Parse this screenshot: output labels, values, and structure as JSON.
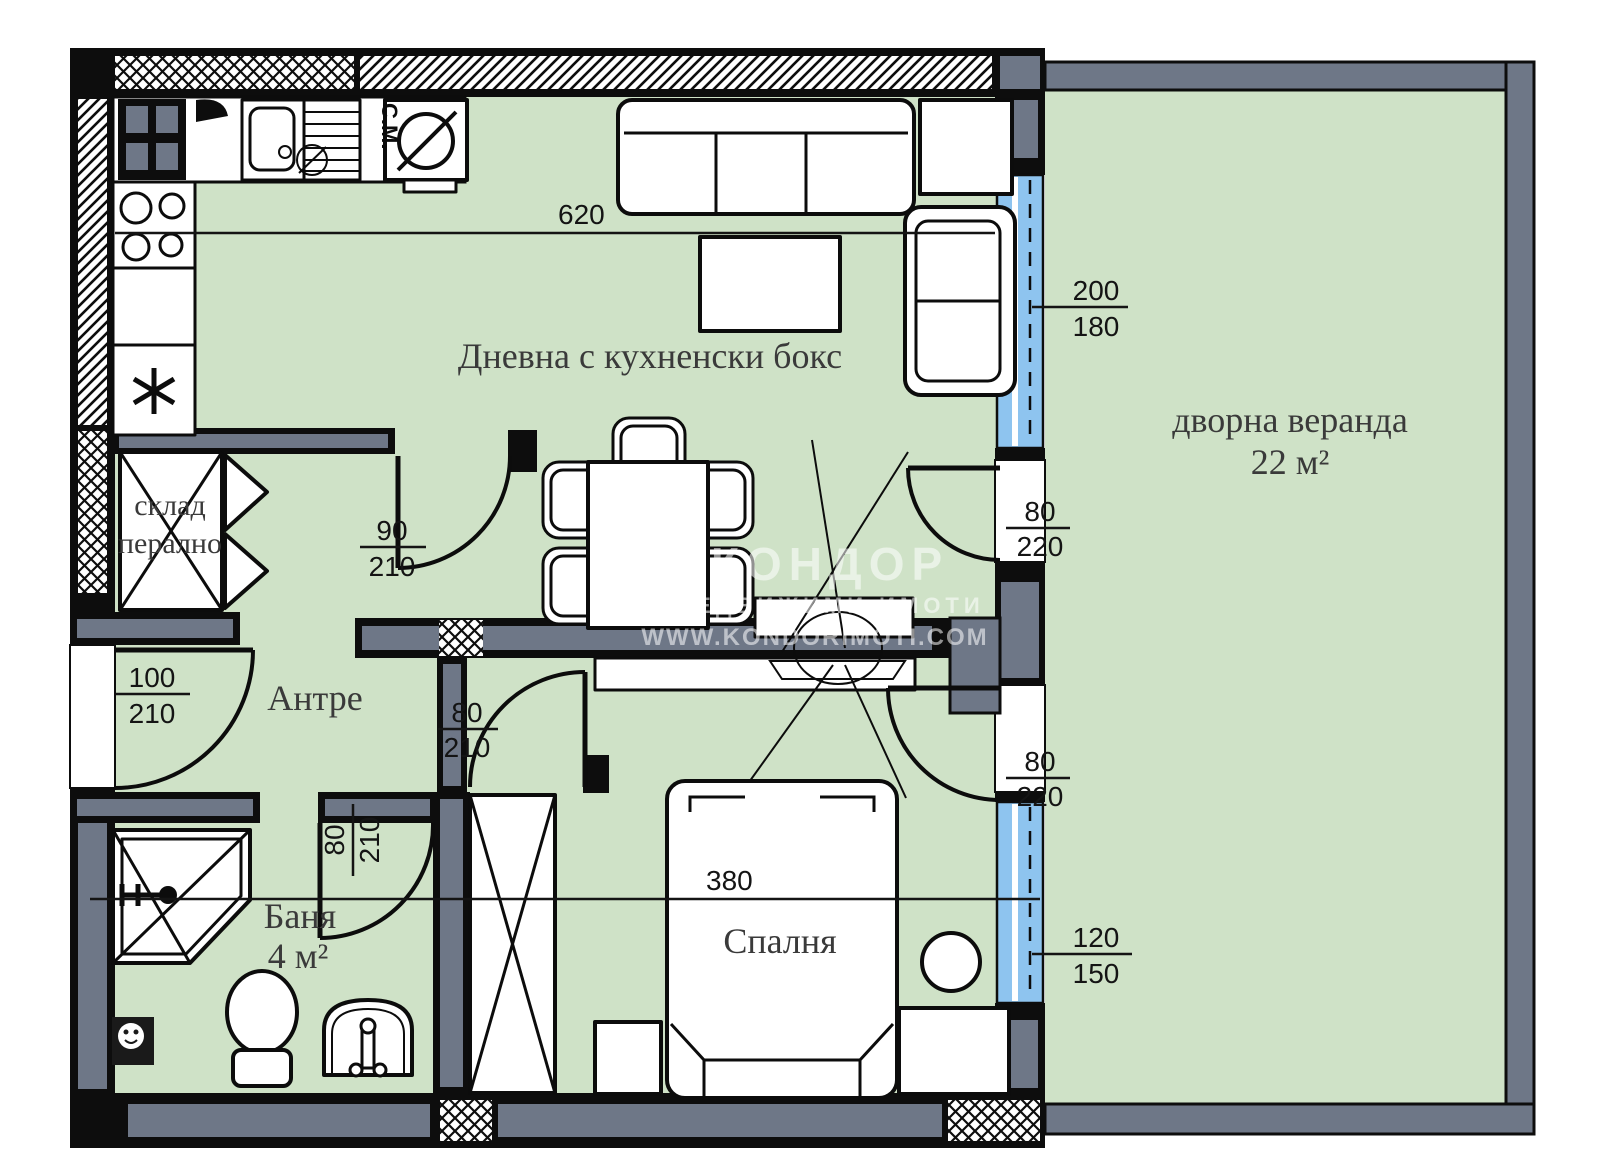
{
  "document": {
    "type": "apartment-floor-plan"
  },
  "rooms": {
    "living": {
      "label": "Дневна с кухненски бокс"
    },
    "veranda": {
      "label": "дворна веранда",
      "area": "22 м²"
    },
    "antre": {
      "label": "Антре"
    },
    "bath": {
      "label": "Баня",
      "area": "4 м²"
    },
    "bedroom": {
      "label": "Спалня"
    },
    "storage": {
      "label_line1": "склад",
      "label_line2": "перално"
    }
  },
  "appliances": {
    "washing_machine_abbr": "С.М."
  },
  "dimensions": {
    "living_width": "620",
    "bedroom_width": "380",
    "window_living": {
      "w": "200",
      "h": "180"
    },
    "door_terrace_top": {
      "w": "80",
      "h": "220"
    },
    "door_living": {
      "w": "90",
      "h": "210"
    },
    "door_entrance": {
      "w": "100",
      "h": "210"
    },
    "door_bedroom": {
      "w": "80",
      "h": "210"
    },
    "door_bath": {
      "w": "80",
      "h": "210"
    },
    "door_terrace_bottom": {
      "w": "80",
      "h": "220"
    },
    "window_bedroom": {
      "w": "120",
      "h": "150"
    }
  },
  "watermark": {
    "line1": "КОНДОР",
    "line2": "НЕДВИЖИМИ ИМОТИ",
    "line3": "WWW.KONDORIMOTI.COM"
  },
  "colors": {
    "floor": "#cfe2c7",
    "window_glass": "#8ec4ef",
    "wall_gray": "#6e7787",
    "ink": "#0d0d0d"
  }
}
